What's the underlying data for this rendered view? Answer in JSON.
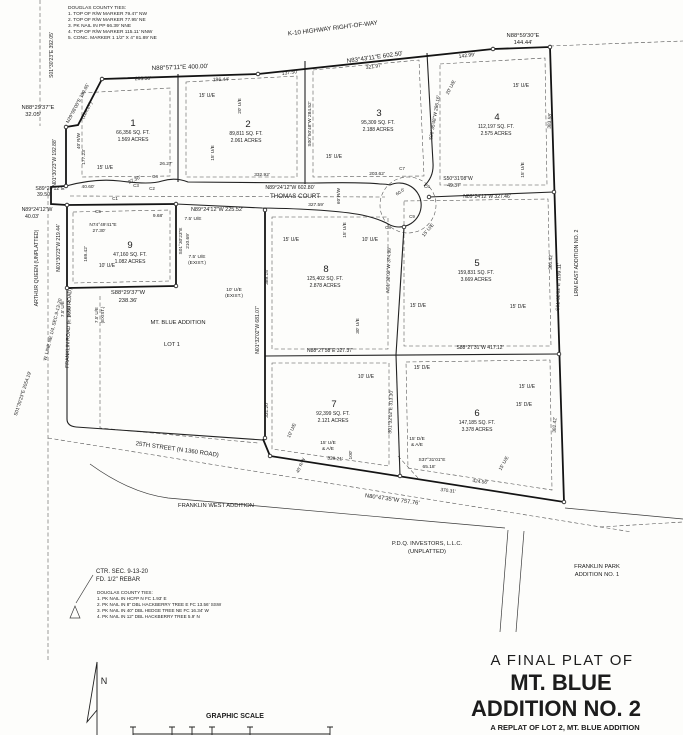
{
  "ink": "#1c1c1c",
  "bg": "#fdfdfb",
  "labels": [
    {
      "name": "ties-top-heading",
      "t": "DOUGLAS COUNTY TIES:",
      "x": 68,
      "y": 9,
      "s": 4.8,
      "a": "start"
    },
    {
      "t": "1. TOP OF R/W MARKER 79.47' NW",
      "x": 68,
      "y": 15,
      "s": 4.8,
      "a": "start"
    },
    {
      "t": "2. TOP OF R/W MARKER 77.95' NE",
      "x": 68,
      "y": 21,
      "s": 4.8,
      "a": "start"
    },
    {
      "t": "3. PK NAIL IN PP 66.39' NNE",
      "x": 68,
      "y": 27,
      "s": 4.8,
      "a": "start"
    },
    {
      "t": "4. TOP OF R/W MARKER 115.11' NNW",
      "x": 68,
      "y": 33,
      "s": 4.8,
      "a": "start"
    },
    {
      "t": "5. CONC. MARKER 1 1/2\" X 4\" 81.89' NE",
      "x": 68,
      "y": 39,
      "s": 4.8,
      "a": "start"
    },
    {
      "name": "k10-highway-label",
      "t": "K-10 HIGHWAY RIGHT-OF-WAY",
      "x": 333,
      "y": 30,
      "r": -7,
      "s": 6.2
    },
    {
      "t": "N88°57'11\"E  400.00'",
      "x": 180,
      "y": 69,
      "r": -2,
      "s": 6.2
    },
    {
      "t": "203.56'",
      "x": 143,
      "y": 80,
      "r": -2,
      "s": 5
    },
    {
      "t": "196.44'",
      "x": 221,
      "y": 81,
      "r": -2,
      "s": 5
    },
    {
      "t": "137.50'",
      "x": 290,
      "y": 74,
      "r": -7,
      "s": 5
    },
    {
      "t": "N83°43'11\"E  602.50'",
      "x": 375,
      "y": 59,
      "r": -8,
      "s": 6.2
    },
    {
      "t": "321.97'",
      "x": 374,
      "y": 68,
      "r": -8,
      "s": 5
    },
    {
      "t": "142.99'",
      "x": 467,
      "y": 57,
      "r": -7,
      "s": 5
    },
    {
      "t": "N88°59'30\"E",
      "x": 523,
      "y": 37,
      "s": 5.8
    },
    {
      "t": "144.44'",
      "x": 523,
      "y": 44,
      "s": 5.8
    },
    {
      "t": "S01°30'23\"E  392.05'",
      "x": 53,
      "y": 55,
      "r": -90,
      "s": 5
    },
    {
      "t": "N88°29'37\"E",
      "x": 38,
      "y": 109,
      "s": 5.8
    },
    {
      "t": "32.05'",
      "x": 33,
      "y": 116,
      "s": 5.8
    },
    {
      "t": "N29°08'00\"E  139.65'",
      "x": 79,
      "y": 104,
      "r": -62,
      "s": 4.8
    },
    {
      "t": "(124.27')",
      "x": 88,
      "y": 111,
      "r": -62,
      "s": 4.8
    },
    {
      "t": "40' R/W",
      "x": 80,
      "y": 141,
      "r": -90,
      "s": 4.5
    },
    {
      "t": "177.23'",
      "x": 85,
      "y": 157,
      "r": -90,
      "s": 4.8
    },
    {
      "t": "N01°30'23\"W  192.88'",
      "x": 56,
      "y": 163,
      "r": -90,
      "s": 5
    },
    {
      "t": "S89°24'12\"E",
      "x": 50,
      "y": 190,
      "s": 5.2
    },
    {
      "t": "39.50'",
      "x": 44,
      "y": 196,
      "s": 5.2
    },
    {
      "t": "N89°24'12\"W",
      "x": 37,
      "y": 211,
      "s": 5.2
    },
    {
      "t": "40.03'",
      "x": 32,
      "y": 218,
      "s": 5.2
    },
    {
      "t": "C1",
      "x": 115,
      "y": 200,
      "s": 4.5
    },
    {
      "t": "C2",
      "x": 152,
      "y": 190,
      "s": 4.5
    },
    {
      "t": "C3",
      "x": 136,
      "y": 187,
      "s": 4.5
    },
    {
      "t": "C4",
      "x": 155,
      "y": 178,
      "s": 4.5
    },
    {
      "t": "C5",
      "x": 98,
      "y": 213,
      "s": 4.5
    },
    {
      "t": "C6",
      "x": 427,
      "y": 188,
      "s": 4.5
    },
    {
      "t": "C7",
      "x": 402,
      "y": 170,
      "s": 4.5
    },
    {
      "t": "C8",
      "x": 388,
      "y": 229,
      "s": 4.5
    },
    {
      "t": "C9",
      "x": 412,
      "y": 218,
      "s": 4.5
    },
    {
      "t": "26.27'",
      "x": 166,
      "y": 165,
      "s": 4.8
    },
    {
      "t": "40.60'",
      "x": 88,
      "y": 188,
      "s": 4.8
    },
    {
      "t": "27.30'",
      "x": 135,
      "y": 181,
      "r": -25,
      "s": 4.8
    },
    {
      "t": "N74°49'41\"E",
      "x": 103,
      "y": 226,
      "s": 4.8
    },
    {
      "t": "27.30'",
      "x": 99,
      "y": 232,
      "s": 4.8
    },
    {
      "t": "9.68'",
      "x": 158,
      "y": 217,
      "s": 4.8
    },
    {
      "t": "7.5' U/E",
      "x": 193,
      "y": 220,
      "s": 4.8
    },
    {
      "name": "thomas-court-bearing",
      "t": "N89°24'12\"W  602.80'",
      "x": 290,
      "y": 189,
      "s": 5.2
    },
    {
      "name": "thomas-court-label",
      "t": "THOMAS COURT",
      "x": 295,
      "y": 198,
      "s": 6.2
    },
    {
      "t": "N89°24'12\"W  225.52'",
      "x": 217,
      "y": 211,
      "s": 5.5
    },
    {
      "t": "327.59'",
      "x": 316,
      "y": 206,
      "s": 4.8
    },
    {
      "t": "60' R/W",
      "x": 340,
      "y": 196,
      "r": -90,
      "s": 4.5
    },
    {
      "t": "60.0'",
      "x": 401,
      "y": 193,
      "r": -35,
      "s": 4.5
    },
    {
      "t": "S50°31'08\"W",
      "x": 458,
      "y": 180,
      "s": 5
    },
    {
      "t": "49.37'",
      "x": 454,
      "y": 187,
      "s": 5
    },
    {
      "t": "N89°24'12\"W  327.46'",
      "x": 487,
      "y": 198,
      "s": 5
    },
    {
      "t": "15' U/E",
      "x": 429,
      "y": 231,
      "r": -50,
      "s": 4.8
    },
    {
      "name": "lot-1-number",
      "t": "1",
      "x": 133,
      "y": 126,
      "s": 9.5
    },
    {
      "t": "66,356 SQ. FT.",
      "x": 133,
      "y": 134,
      "s": 5
    },
    {
      "t": "1.569 ACRES",
      "x": 133,
      "y": 141,
      "s": 5
    },
    {
      "name": "lot-2-number",
      "t": "2",
      "x": 248,
      "y": 127,
      "s": 9.5
    },
    {
      "t": "89,811 SQ. FT.",
      "x": 246,
      "y": 135,
      "s": 5
    },
    {
      "t": "2.061 ACRES",
      "x": 246,
      "y": 142,
      "s": 5
    },
    {
      "name": "lot-3-number",
      "t": "3",
      "x": 379,
      "y": 116,
      "s": 9.5
    },
    {
      "t": "95,309 SQ. FT.",
      "x": 378,
      "y": 124,
      "s": 5
    },
    {
      "t": "2.188 ACRES",
      "x": 378,
      "y": 131,
      "s": 5
    },
    {
      "name": "lot-4-number",
      "t": "4",
      "x": 497,
      "y": 120,
      "s": 9.5
    },
    {
      "t": "112,197 SQ. FT.",
      "x": 496,
      "y": 128,
      "s": 5
    },
    {
      "t": "2.575 ACRES",
      "x": 496,
      "y": 135,
      "s": 5
    },
    {
      "name": "lot-5-number",
      "t": "5",
      "x": 477,
      "y": 266,
      "s": 9.5
    },
    {
      "t": "159,831 SQ. FT.",
      "x": 476,
      "y": 274,
      "s": 5
    },
    {
      "t": "3.669 ACRES",
      "x": 476,
      "y": 281,
      "s": 5
    },
    {
      "name": "lot-6-number",
      "t": "6",
      "x": 477,
      "y": 416,
      "s": 9.5
    },
    {
      "t": "147,185 SQ. FT.",
      "x": 477,
      "y": 424,
      "s": 5
    },
    {
      "t": "3.378 ACRES",
      "x": 477,
      "y": 431,
      "s": 5
    },
    {
      "name": "lot-7-number",
      "t": "7",
      "x": 334,
      "y": 407,
      "s": 9.5
    },
    {
      "t": "92,399 SQ. FT.",
      "x": 333,
      "y": 415,
      "s": 5
    },
    {
      "t": "2.121 ACRES",
      "x": 333,
      "y": 422,
      "s": 5
    },
    {
      "name": "lot-8-number",
      "t": "8",
      "x": 326,
      "y": 272,
      "s": 9.5
    },
    {
      "t": "125,402 SQ. FT.",
      "x": 325,
      "y": 280,
      "s": 5
    },
    {
      "t": "2.878 ACRES",
      "x": 325,
      "y": 287,
      "s": 5
    },
    {
      "name": "lot-9-number",
      "t": "9",
      "x": 130,
      "y": 248,
      "s": 9.5
    },
    {
      "t": "47,160 SQ. FT.",
      "x": 130,
      "y": 256,
      "s": 5
    },
    {
      "t": "1.082 ACRES",
      "x": 130,
      "y": 263,
      "s": 5
    },
    {
      "t": "15' U/E",
      "x": 207,
      "y": 97,
      "s": 5
    },
    {
      "t": "20' U/E",
      "x": 241,
      "y": 106,
      "r": -90,
      "s": 4.8
    },
    {
      "t": "15' U/E",
      "x": 214,
      "y": 153,
      "r": -90,
      "s": 4.8
    },
    {
      "t": "15' U/E",
      "x": 105,
      "y": 169,
      "s": 5
    },
    {
      "t": "15' U/E",
      "x": 334,
      "y": 158,
      "s": 5
    },
    {
      "t": "S00°50'48\"W  284.52'",
      "x": 311,
      "y": 124,
      "r": -90,
      "s": 4.8
    },
    {
      "t": "332.92'",
      "x": 262,
      "y": 176,
      "s": 4.8
    },
    {
      "t": "203.62'",
      "x": 377,
      "y": 175,
      "s": 4.8
    },
    {
      "t": "15' U/E",
      "x": 521,
      "y": 87,
      "s": 5
    },
    {
      "t": "20' U/E",
      "x": 452,
      "y": 88,
      "r": -62,
      "s": 4.8
    },
    {
      "t": "S00°35'48\"W  286.16'",
      "x": 436,
      "y": 118,
      "r": -80,
      "s": 4.8
    },
    {
      "t": "383.58'",
      "x": 551,
      "y": 121,
      "r": -87,
      "s": 4.8
    },
    {
      "t": "15' U/E",
      "x": 524,
      "y": 170,
      "r": -90,
      "s": 4.8
    },
    {
      "t": "15' U/E",
      "x": 291,
      "y": 241,
      "s": 5
    },
    {
      "t": "10' U/E",
      "x": 370,
      "y": 241,
      "s": 5
    },
    {
      "t": "15' U/E",
      "x": 346,
      "y": 230,
      "r": -90,
      "s": 4.8
    },
    {
      "t": "N01°32'02\"W  374.98'",
      "x": 390,
      "y": 270,
      "r": -88,
      "s": 4.8
    },
    {
      "t": "15' D/E",
      "x": 418,
      "y": 307,
      "s": 5
    },
    {
      "t": "15' D/E",
      "x": 518,
      "y": 308,
      "s": 5
    },
    {
      "t": "30' U/E",
      "x": 359,
      "y": 326,
      "r": -90,
      "s": 4.8
    },
    {
      "t": "N88°27'58\"E  327.37'",
      "x": 330,
      "y": 352,
      "s": 5
    },
    {
      "t": "S88°27'31\"W  417.12'",
      "x": 480,
      "y": 349,
      "s": 5
    },
    {
      "t": "N01°32'02\"W  681.07'",
      "x": 259,
      "y": 330,
      "r": -90,
      "s": 5
    },
    {
      "t": "389.15'",
      "x": 268,
      "y": 277,
      "r": -90,
      "s": 4.8
    },
    {
      "t": "331.20'",
      "x": 268,
      "y": 410,
      "r": -90,
      "s": 4.8
    },
    {
      "t": "10' U/E",
      "x": 234,
      "y": 291,
      "s": 4.8
    },
    {
      "t": "(EXIST.)",
      "x": 234,
      "y": 297,
      "s": 4.8
    },
    {
      "t": "7.5' U/E",
      "x": 197,
      "y": 258,
      "s": 4.8
    },
    {
      "t": "(EXIST.)",
      "x": 197,
      "y": 264,
      "s": 4.8
    },
    {
      "t": "S01°30'23\"E",
      "x": 182,
      "y": 241,
      "r": -90,
      "s": 4.8
    },
    {
      "t": "210.69'",
      "x": 189,
      "y": 241,
      "r": -90,
      "s": 4.8
    },
    {
      "t": "10' U/E",
      "x": 107,
      "y": 267,
      "s": 5
    },
    {
      "t": "169.42'",
      "x": 87,
      "y": 254,
      "r": -90,
      "s": 4.8
    },
    {
      "t": "N01°30'23\"W  219.44'",
      "x": 60,
      "y": 248,
      "r": -90,
      "s": 5
    },
    {
      "t": "S88°29'37\"W",
      "x": 128,
      "y": 294,
      "s": 5.8
    },
    {
      "t": "238.36'",
      "x": 128,
      "y": 302,
      "s": 5.8
    },
    {
      "t": "7.5' U/E",
      "x": 64,
      "y": 309,
      "r": -90,
      "s": 4.5
    },
    {
      "t": "(EXIST.)",
      "x": 70,
      "y": 309,
      "r": -90,
      "s": 4.5
    },
    {
      "t": "7.5' U/E",
      "x": 98,
      "y": 315,
      "r": -90,
      "s": 4.5
    },
    {
      "t": "(EXIST.)",
      "x": 104,
      "y": 315,
      "r": -90,
      "s": 4.5
    },
    {
      "name": "mt-blue-addition-label",
      "t": "MT. BLUE ADDITION",
      "x": 178,
      "y": 324,
      "s": 5.8
    },
    {
      "name": "existing-lot-1-label",
      "t": "LOT 1",
      "x": 172,
      "y": 346,
      "s": 5.8
    },
    {
      "t": "360.42'",
      "x": 552,
      "y": 262,
      "r": -88,
      "s": 4.8
    },
    {
      "t": "S01°32'02\"E  1199.11'",
      "x": 560,
      "y": 287,
      "r": -88,
      "s": 5
    },
    {
      "name": "lrm-east-addition-label",
      "t": "LRM EAST ADDITION NO. 2",
      "x": 578,
      "y": 263,
      "r": -90,
      "s": 5.2
    },
    {
      "t": "10' U/E",
      "x": 366,
      "y": 378,
      "s": 5
    },
    {
      "t": "15' D/E",
      "x": 422,
      "y": 369,
      "s": 5
    },
    {
      "t": "S01°32'02\"E  313.30'",
      "x": 392,
      "y": 412,
      "r": -88,
      "s": 4.8
    },
    {
      "t": "15' U/E",
      "x": 328,
      "y": 444,
      "s": 4.8
    },
    {
      "t": "& A/E",
      "x": 328,
      "y": 450,
      "s": 4.8
    },
    {
      "t": "15' D/E",
      "x": 417,
      "y": 440,
      "s": 4.8
    },
    {
      "t": "& A/E",
      "x": 417,
      "y": 446,
      "s": 4.8
    },
    {
      "t": "100'",
      "x": 352,
      "y": 455,
      "r": -90,
      "s": 4.8
    },
    {
      "t": "339.21'",
      "x": 335,
      "y": 460,
      "r": 4,
      "s": 4.8
    },
    {
      "t": "S37°31'01\"E",
      "x": 432,
      "y": 461,
      "s": 4.8
    },
    {
      "t": "65.18'",
      "x": 429,
      "y": 468,
      "s": 4.8
    },
    {
      "t": "10' U/E",
      "x": 293,
      "y": 431,
      "r": -65,
      "s": 4.8
    },
    {
      "t": "40' R/W",
      "x": 302,
      "y": 466,
      "r": -65,
      "s": 4.5
    },
    {
      "t": "15' U/E",
      "x": 527,
      "y": 388,
      "s": 5
    },
    {
      "t": "15' D/E",
      "x": 524,
      "y": 406,
      "s": 5
    },
    {
      "t": "382.42'",
      "x": 556,
      "y": 425,
      "r": -87,
      "s": 4.8
    },
    {
      "t": "15' U/E",
      "x": 505,
      "y": 464,
      "r": -60,
      "s": 4.8
    },
    {
      "t": "424.56'",
      "x": 480,
      "y": 483,
      "r": 7,
      "s": 4.8
    },
    {
      "t": "370.31'",
      "x": 448,
      "y": 492,
      "r": 7,
      "s": 4.8
    },
    {
      "t": "N80°47'35\"W  757.76'",
      "x": 392,
      "y": 501,
      "r": 8,
      "s": 5.8
    },
    {
      "name": "street-25th-label",
      "t": "25TH STREET  (N 1360 ROAD)",
      "x": 177,
      "y": 451,
      "r": 8,
      "s": 6
    },
    {
      "name": "franklin-west-addition-label",
      "t": "FRANKLIN WEST ADDITION",
      "x": 216,
      "y": 507,
      "s": 5.8
    },
    {
      "name": "pdq-investors-label",
      "t": "P.D.Q. INVESTORS, L.L.C.",
      "x": 427,
      "y": 545,
      "s": 5.8
    },
    {
      "t": "(UNPLATTED)",
      "x": 427,
      "y": 553,
      "s": 5.8
    },
    {
      "name": "franklin-park-label",
      "t": "FRANKLIN PARK",
      "x": 597,
      "y": 568,
      "s": 5.8
    },
    {
      "t": "ADDITION NO. 1",
      "x": 597,
      "y": 576,
      "s": 5.8
    },
    {
      "name": "arthur-queen-label",
      "t": "ARTHUR QUEEN (UNPLATTED)",
      "x": 38,
      "y": 268,
      "r": -90,
      "s": 5.2
    },
    {
      "t": "W. LINE NE 1/4, SEC.9-13-20",
      "x": 54,
      "y": 330,
      "r": -76,
      "s": 4.8
    },
    {
      "name": "franklin-road-label",
      "t": "FRANKLIN ROAD (E 1650 ROAD)",
      "x": 70,
      "y": 328,
      "r": -88,
      "s": 5.2
    },
    {
      "t": "S01°30'23\"E  2054.19'",
      "x": 24,
      "y": 394,
      "r": -72,
      "s": 4.8
    },
    {
      "name": "center-section-note-1",
      "t": "CTR. SEC. 9-13-20",
      "x": 96,
      "y": 573,
      "s": 6,
      "a": "start"
    },
    {
      "name": "center-section-note-2",
      "t": "FD. 1/2\" REBAR",
      "x": 96,
      "y": 581,
      "s": 6,
      "a": "start"
    },
    {
      "name": "ties-bottom-heading",
      "t": "DOUGLAS COUNTY TIES:",
      "x": 97,
      "y": 594,
      "s": 4.6,
      "a": "start"
    },
    {
      "t": "1. PK NAIL IN HCFP N FC 1.93' E",
      "x": 97,
      "y": 600,
      "s": 4.6,
      "a": "start"
    },
    {
      "t": "2. PK NAIL IN 8\" DBL HACKBERRY TREE E FC 13.56' SSW",
      "x": 97,
      "y": 606,
      "s": 4.6,
      "a": "start"
    },
    {
      "t": "3. PK NAIL IN 40\" DBL HEDGE TREE NE FC 16.34' W",
      "x": 97,
      "y": 612,
      "s": 4.6,
      "a": "start"
    },
    {
      "t": "4. PK NAIL IN 12\" DBL HACKBERRY TREE 5.9' N",
      "x": 97,
      "y": 618,
      "s": 4.6,
      "a": "start"
    },
    {
      "name": "north-label",
      "t": "N",
      "x": 104,
      "y": 684,
      "s": 9
    },
    {
      "name": "graphic-scale-label",
      "t": "GRAPHIC SCALE",
      "x": 235,
      "y": 718,
      "s": 7,
      "w": "bold"
    },
    {
      "name": "title-line-1",
      "t": "A  FINAL  PLAT  OF",
      "x": 562,
      "y": 665,
      "s": 15,
      "ls": 1.5
    },
    {
      "name": "title-line-2",
      "t": "MT. BLUE",
      "x": 561,
      "y": 690,
      "s": 22,
      "w": "bold"
    },
    {
      "name": "title-line-3",
      "t": "ADDITION NO. 2",
      "x": 556,
      "y": 716,
      "s": 22,
      "w": "bold"
    },
    {
      "name": "title-line-4",
      "t": "A REPLAT OF LOT 2, MT. BLUE ADDITION",
      "x": 565,
      "y": 730,
      "s": 7.5,
      "w": "bold"
    }
  ]
}
